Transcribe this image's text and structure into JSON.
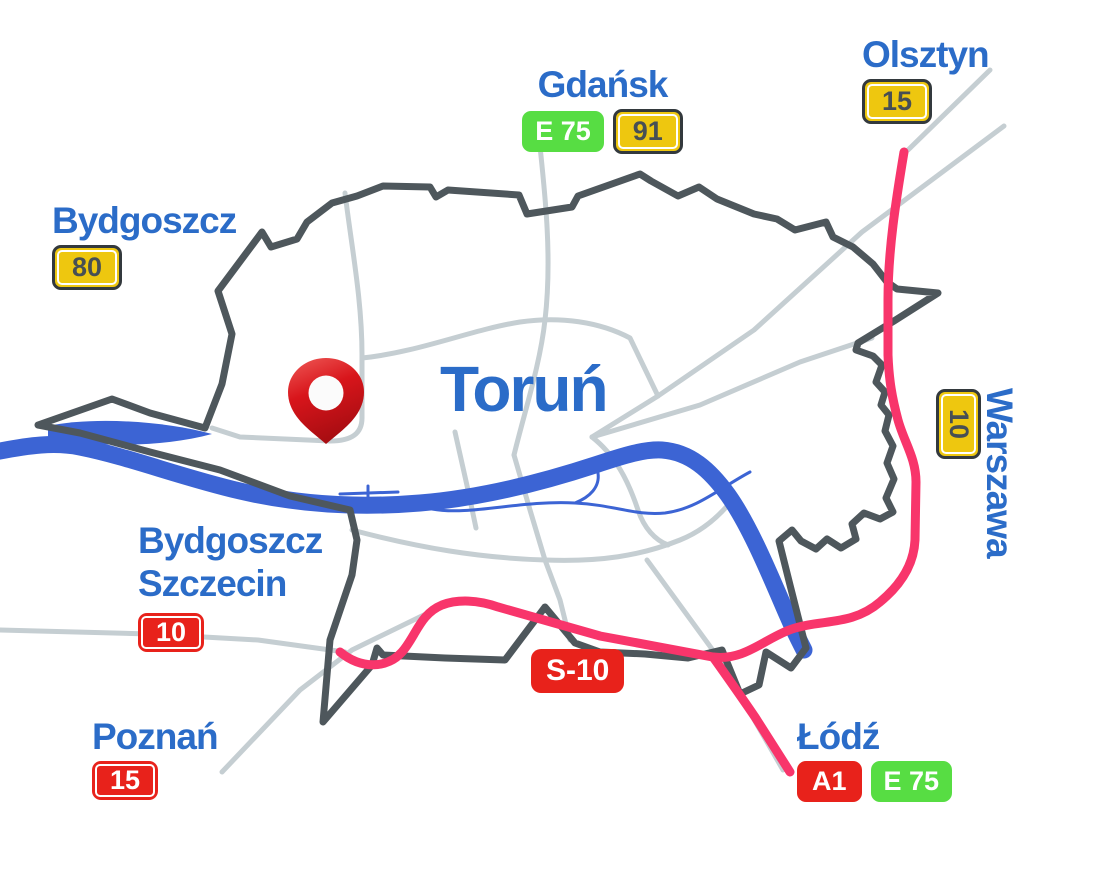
{
  "map": {
    "city": {
      "title": "Toruń"
    },
    "destinations": {
      "gdansk": {
        "name": "Gdańsk",
        "badges": {
          "e75": "E 75",
          "n91": "91"
        }
      },
      "olsztyn": {
        "name": "Olsztyn",
        "badges": {
          "n15": "15"
        }
      },
      "bydgoszcz": {
        "name": "Bydgoszcz",
        "badges": {
          "n80": "80"
        }
      },
      "warszawa": {
        "name": "Warszawa",
        "badges": {
          "n10": "10"
        }
      },
      "bydgoszcz_szczecin": {
        "line1": "Bydgoszcz",
        "line2": "Szczecin",
        "badges": {
          "n10": "10"
        }
      },
      "poznan": {
        "name": "Poznań",
        "badges": {
          "n15": "15"
        }
      },
      "lodz": {
        "name": "Łódź",
        "badges": {
          "a1": "A1",
          "e75": "E 75"
        }
      }
    },
    "route_labels": {
      "s10": "S-10"
    },
    "colors": {
      "city_label_blue": "#2b6cc8",
      "boundary_gray": "#4e575c",
      "minor_road_gray": "#c5ced2",
      "river_blue": "#3c64d4",
      "route_pink": "#f8356b",
      "badge_yellow": "#eec70f",
      "badge_red": "#e8221b",
      "badge_green": "#57dd43",
      "pin_red": "#d8151b"
    }
  }
}
